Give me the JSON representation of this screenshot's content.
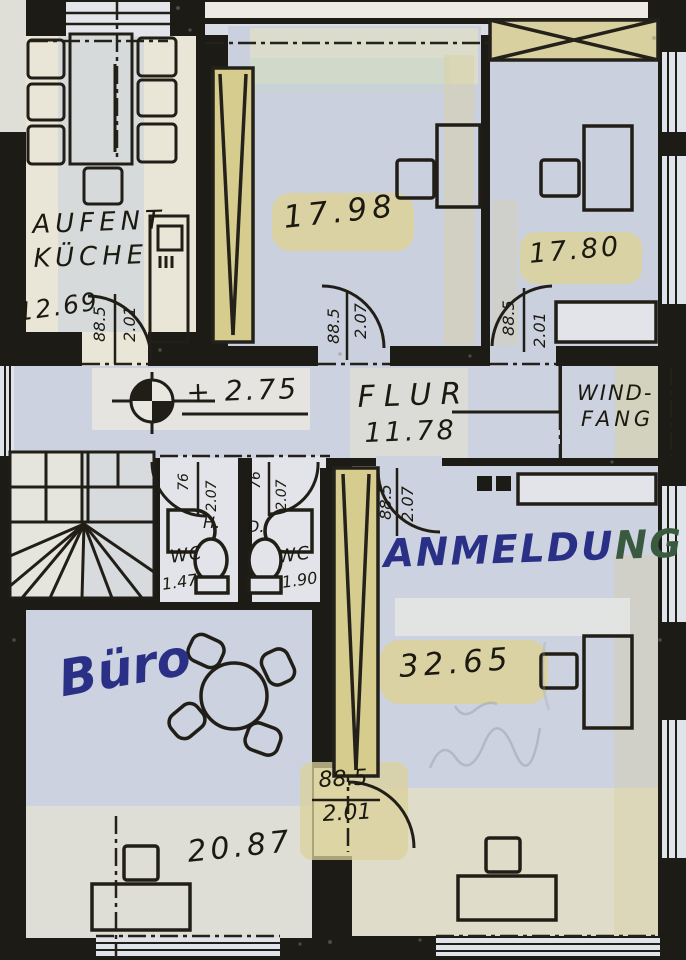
{
  "colors": {
    "wall": "#1d1b16",
    "paper_cream": "#e9e6d6",
    "photocopy_blue": "#cbd1df",
    "highlight_yellow": "#d9d09a",
    "ink": "#1b1910",
    "marker_blue": "#2b3087",
    "marker_green": "#3a5a40"
  },
  "rooms": {
    "kueche": {
      "name_line1": "AUFENT",
      "name_line2": "KÜCHE",
      "area": "12.69"
    },
    "zimmer_links": {
      "area": "17.98"
    },
    "zimmer_rechts": {
      "area": "17.80"
    },
    "flur": {
      "name": "FLUR",
      "area": "11.78"
    },
    "windfang": {
      "name_line1": "WIND-",
      "name_line2": "FANG"
    },
    "wc_herren": {
      "prefix": "H.",
      "name": "WC",
      "area": "1.47"
    },
    "wc_damen": {
      "prefix": "D.",
      "name": "WC",
      "area": "1.90"
    },
    "buero": {
      "name": "Büro",
      "area": "20.87"
    },
    "anmeldung": {
      "name_part1": "ANMELDU",
      "name_part2": "NG",
      "area": "32.65"
    }
  },
  "level_marker": {
    "value": "+ 2.75"
  },
  "doors": {
    "kueche": {
      "w": "88.5",
      "h": "2.01"
    },
    "zimmer_links": {
      "w": "88.5",
      "h": "2.07"
    },
    "zimmer_rechts": {
      "w": "88.5",
      "h": "2.01"
    },
    "wc_herren": {
      "w": "76",
      "h": "2.07"
    },
    "wc_damen": {
      "w": "76",
      "h": "2.07"
    },
    "anmeldung": {
      "w": "88.5",
      "h": "2.07"
    },
    "buero": {
      "w": "88.5",
      "h": "2.01"
    }
  }
}
